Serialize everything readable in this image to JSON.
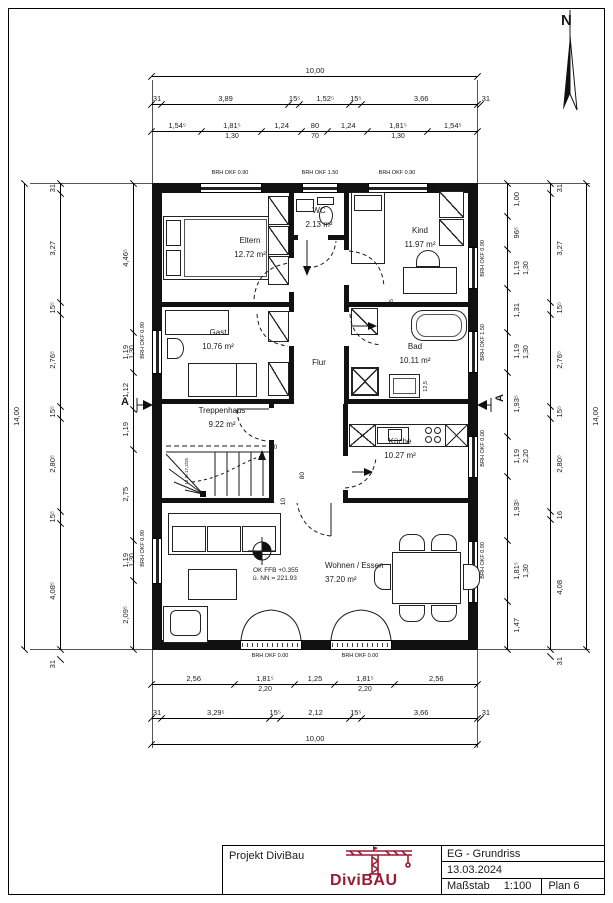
{
  "north_label": "N",
  "rooms": {
    "eltern": {
      "name": "Eltern",
      "area": "12.72 m²"
    },
    "wc": {
      "name": "WC",
      "area": "2.13 m²"
    },
    "kind": {
      "name": "Kind",
      "area": "11.97 m²"
    },
    "gast": {
      "name": "Gast",
      "area": "10.76 m²"
    },
    "flur": {
      "name": "Flur"
    },
    "bad": {
      "name": "Bad",
      "area": "10.11 m²"
    },
    "treppenhaus": {
      "name": "Treppenhaus",
      "area": "9.22 m²"
    },
    "kueche": {
      "name": "Küche",
      "area": "10.27 m²"
    },
    "wohnen": {
      "name": "Wohnen / Essen",
      "area": "37.20 m²"
    }
  },
  "level": {
    "line1": "OK FFB +0.355",
    "line2": "ü. NN = 221.93"
  },
  "stairs_note": "18 St 17,2/25",
  "section_label": "A",
  "brh": {
    "t1": "BRH OKF 0.90",
    "t2": "BRH OKF 1.50",
    "t3": "BRH OKF 0.90",
    "b1": "BRH OKF 0.00",
    "b2": "BRH OKF 0.00",
    "l1": "BRH OKF 0.90",
    "l2": "BRH OKF 0.90",
    "r1": "BRH OKF 0.90",
    "r2": "BRH OKF 1.50",
    "r3": "BRH OKF 0.00",
    "r4": "BRH OKF 0.90"
  },
  "small_dims": {
    "d50": "50",
    "d80": "80",
    "d10": "10",
    "d65": "65",
    "d125": "12,5"
  },
  "dims": {
    "top": {
      "total": "10,00",
      "row2": [
        "31",
        "3,89",
        "15⁵",
        "1,52⁵",
        "15⁵",
        "3,66",
        "31"
      ],
      "row3": [
        "1,54⁵",
        "1,81⁵",
        "1,24",
        "80",
        "1,24",
        "1,81⁵",
        "1,54⁵"
      ],
      "row3_sub": [
        "",
        "1,30",
        "",
        "70",
        "",
        "1,30",
        ""
      ]
    },
    "bottom": {
      "row1": [
        "2,56",
        "1,81⁵",
        "1,25",
        "1,81⁵",
        "2,56"
      ],
      "row1_sub": [
        "",
        "2,20",
        "",
        "2,20",
        ""
      ],
      "row2": [
        "31",
        "3,29⁵",
        "15⁵",
        "2,12",
        "15⁵",
        "3,66",
        "31"
      ],
      "total": "10,00"
    },
    "left": {
      "total": "14,00",
      "mid": [
        "31",
        "3,27",
        "15⁵",
        "2,76⁵",
        "15⁵",
        "2,80⁵",
        "15⁵",
        "4,08⁵",
        "31"
      ],
      "inner": [
        "4,46⁵",
        "1,19",
        "1,12",
        "1,19",
        "2,75",
        "1,19",
        "2,09⁵"
      ],
      "inner_sub": [
        "",
        "1,30",
        "",
        "",
        "",
        "1,30",
        ""
      ]
    },
    "right": {
      "total": "14,00",
      "mid": [
        "31",
        "3,27",
        "15⁵",
        "2,76⁵",
        "15⁵",
        "2,80⁵",
        "16",
        "4,08",
        "31"
      ],
      "inner": [
        "1,00",
        "96⁵",
        "1,19",
        "1,31",
        "1,19",
        "1,93⁵",
        "1,19",
        "1,93⁵",
        "1,81⁵",
        "1,47"
      ],
      "inner_sub": [
        "",
        "",
        "1,30",
        "",
        "1,30",
        "",
        "2,20",
        "",
        "1,30",
        ""
      ]
    }
  },
  "title_block": {
    "project": "Projekt DiviBau",
    "logo": "DiviBAU",
    "drawing": "EG - Grundriss",
    "date": "13.03.2024",
    "scale_label": "Maßstab",
    "scale_value": "1:100",
    "plan": "Plan 6"
  },
  "colors": {
    "brand": "#9b1b33",
    "line": "#1a1a1a"
  }
}
